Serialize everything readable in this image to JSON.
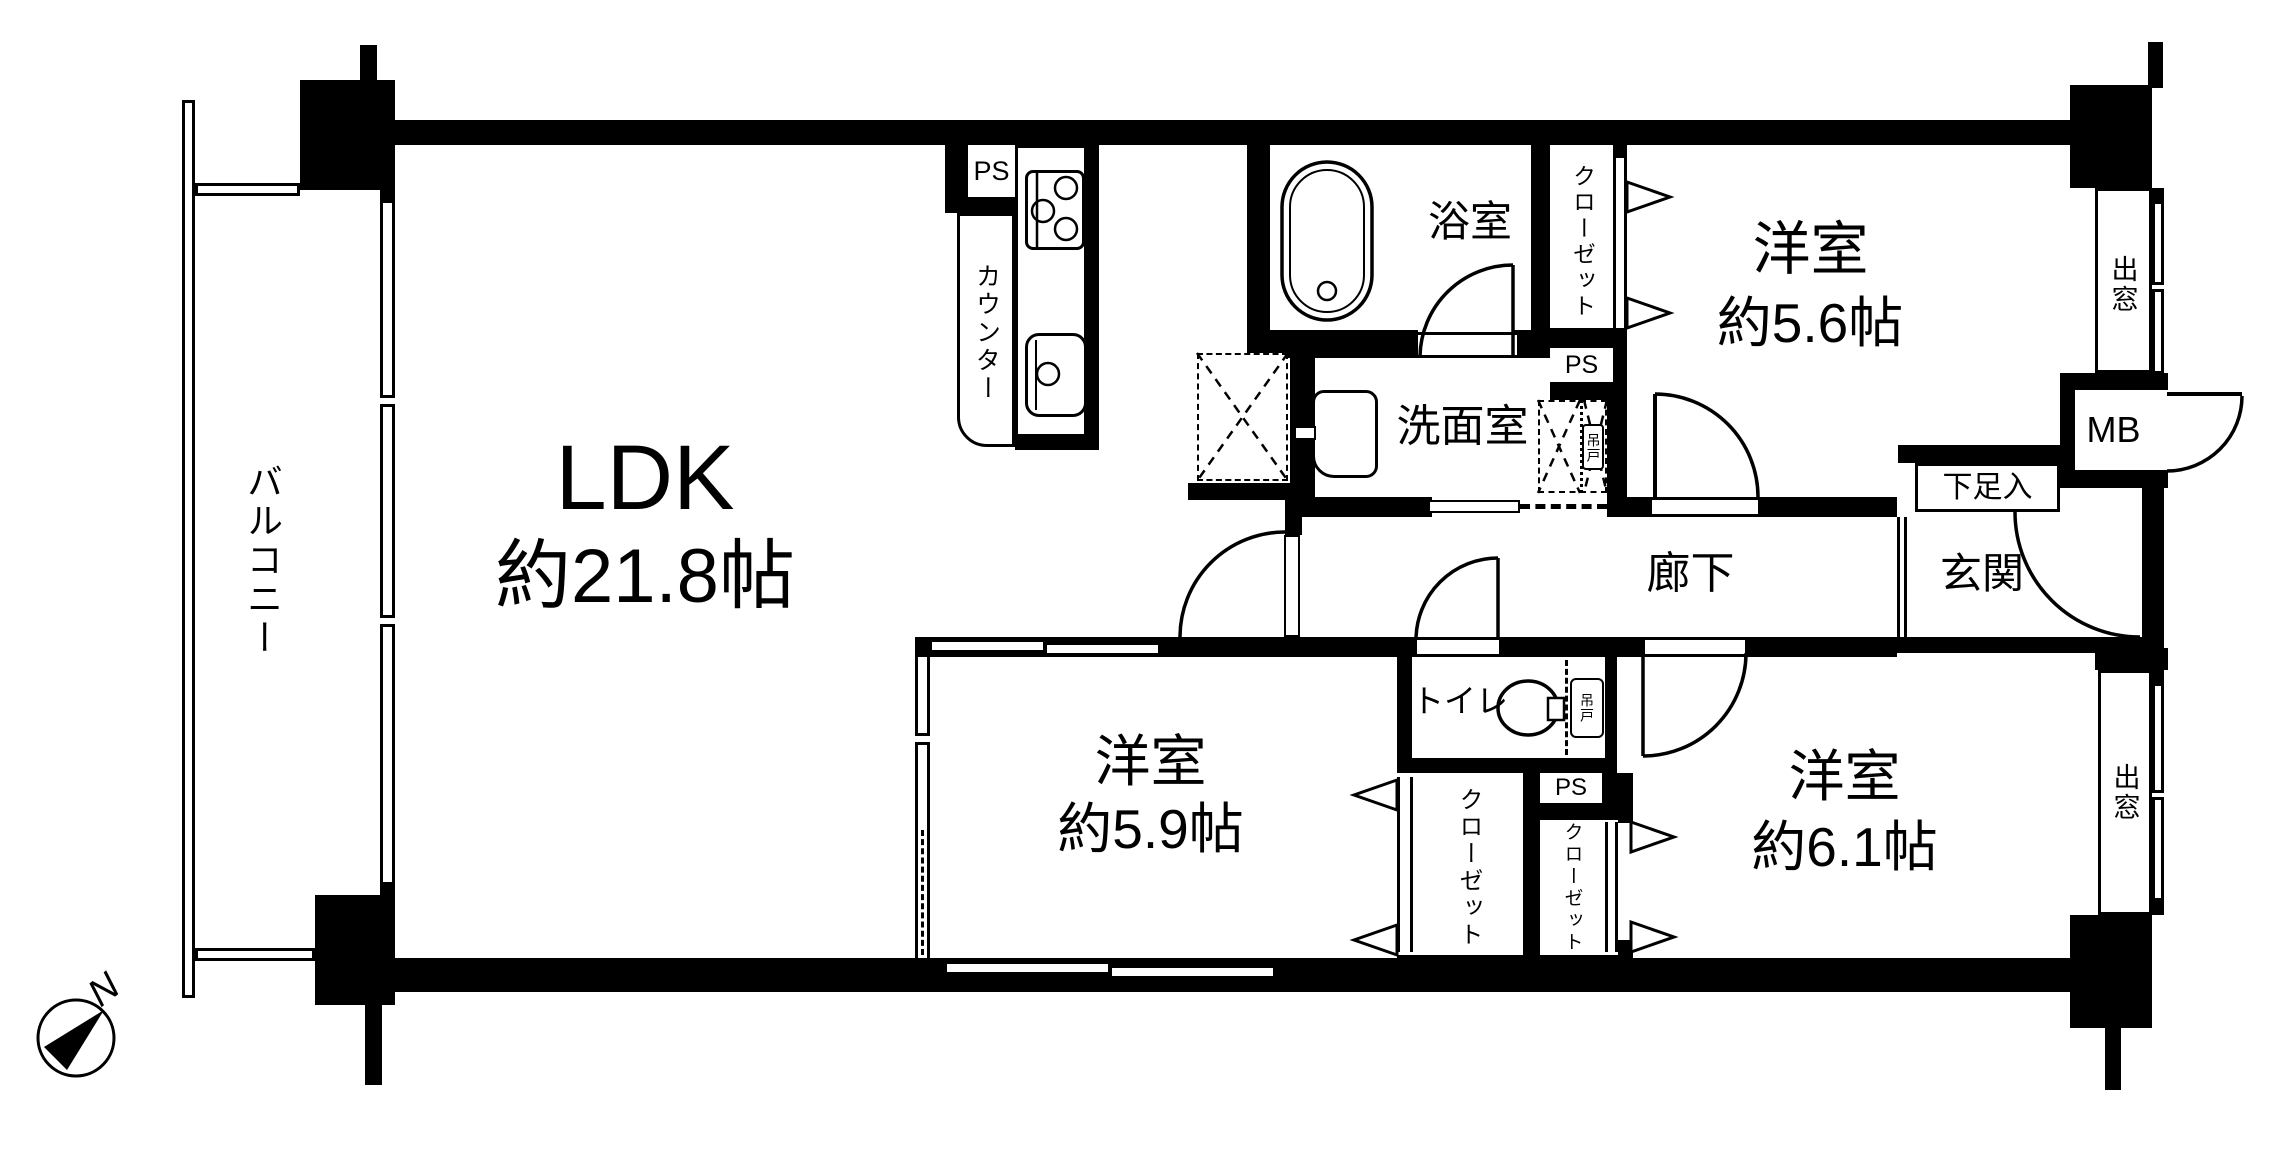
{
  "plan": {
    "compass": {
      "north_label": "N"
    },
    "balcony": {
      "label": "バルコニー"
    },
    "ldk": {
      "name": "LDK",
      "size": "約21.8帖"
    },
    "kitchen": {
      "ps_label": "PS",
      "counter_label": "カウンター"
    },
    "bath": {
      "name": "浴室"
    },
    "washroom": {
      "name": "洗面室",
      "hanging_cabinet_label": "吊戸",
      "ps_label": "PS"
    },
    "closet_upper": {
      "label": "クローゼット"
    },
    "room_ne": {
      "name": "洋室",
      "size": "約5.6帖"
    },
    "bay_window_ne": {
      "label": "出窓"
    },
    "meter_box": {
      "label": "MB"
    },
    "shoe_cabinet": {
      "label": "下足入"
    },
    "entrance": {
      "label": "玄関"
    },
    "hallway": {
      "label": "廊下"
    },
    "toilet": {
      "name": "トイレ",
      "hanging_cabinet_label": "吊戸"
    },
    "ps_lower": {
      "label": "PS"
    },
    "closet_south": {
      "label": "クローゼット"
    },
    "closet_southeast": {
      "label": "クローゼット"
    },
    "room_s": {
      "name": "洋室",
      "size": "約5.9帖"
    },
    "room_se": {
      "name": "洋室",
      "size": "約6.1帖"
    },
    "bay_window_se": {
      "label": "出窓"
    },
    "colors": {
      "wall": "#000000",
      "floor": "#ffffff"
    }
  }
}
